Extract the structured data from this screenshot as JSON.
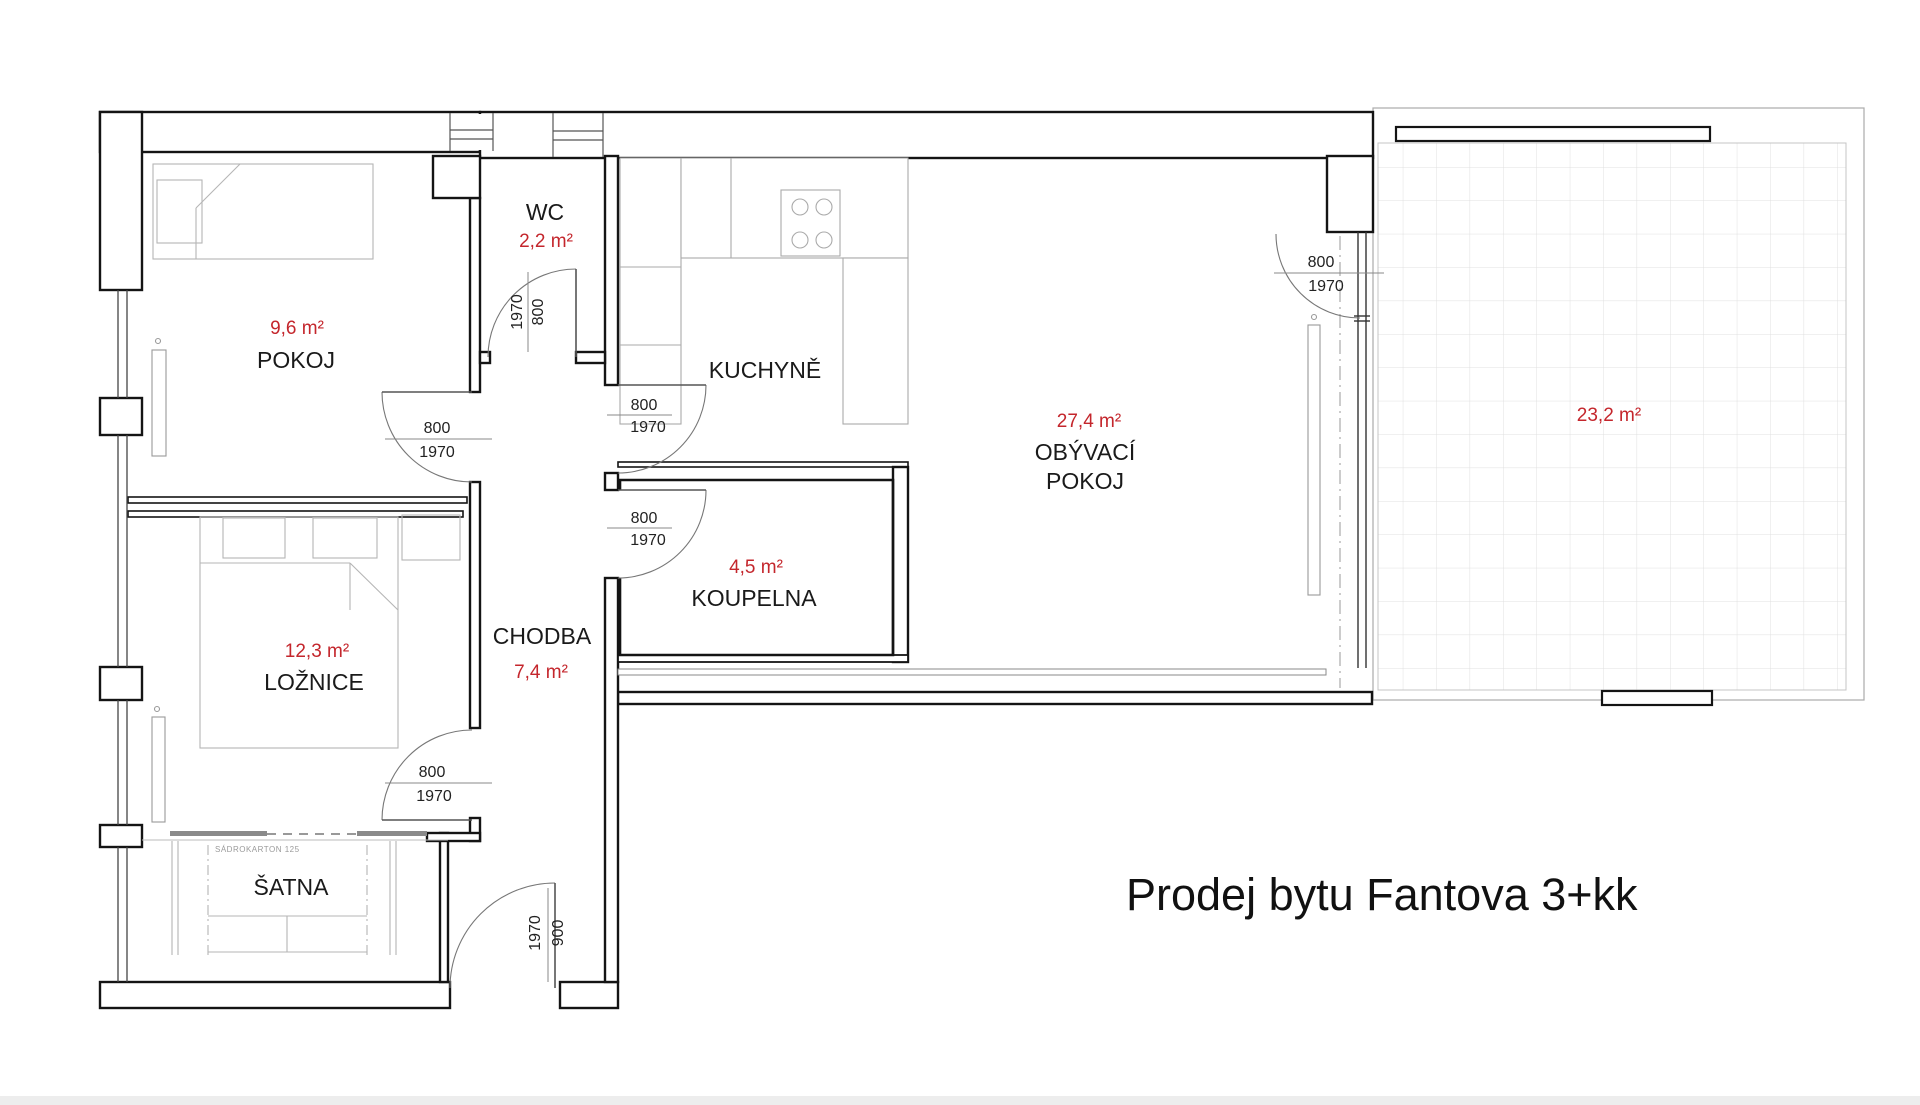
{
  "title": "Prodej bytu Fantova 3+kk",
  "rooms": {
    "pokoj": {
      "name": "POKOJ",
      "area": "9,6 m²"
    },
    "wc": {
      "name": "WC",
      "area": "2,2 m²"
    },
    "kuchyne": {
      "name": "KUCHYNĚ"
    },
    "obyvaci_pokoj": {
      "name_line1": "OBÝVACÍ",
      "name_line2": "POKOJ",
      "area": "27,4 m²"
    },
    "chodba": {
      "name": "CHODBA",
      "area": "7,4 m²"
    },
    "koupelna": {
      "name": "KOUPELNA",
      "area": "4,5 m²"
    },
    "loznice": {
      "name": "LOŽNICE",
      "area": "12,3 m²"
    },
    "satna": {
      "name": "ŠATNA"
    },
    "terasa": {
      "area": "23,2 m²"
    }
  },
  "doors": [
    {
      "id": "wc-door",
      "width": "800",
      "height": "1970"
    },
    {
      "id": "pokoj-door",
      "width": "800",
      "height": "1970"
    },
    {
      "id": "loznice-door",
      "width": "800",
      "height": "1970"
    },
    {
      "id": "kuchyne-door",
      "width": "800",
      "height": "1970"
    },
    {
      "id": "koupelna-door",
      "width": "800",
      "height": "1970"
    },
    {
      "id": "terasa-door",
      "width": "800",
      "height": "1970"
    },
    {
      "id": "entry-door",
      "width": "900",
      "height": "1970"
    }
  ],
  "annotations": {
    "partition_note": "SÁDROKARTON 125"
  },
  "colors": {
    "area_text": "#c4262c",
    "wall_line": "#141414"
  }
}
